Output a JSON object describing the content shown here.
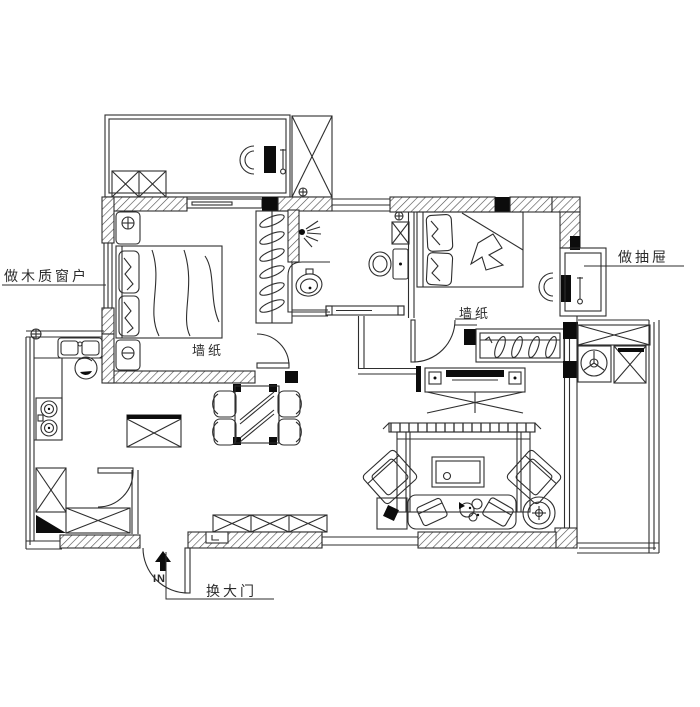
{
  "colors": {
    "background": "#ffffff",
    "ink": "#2e2e2e",
    "solid_wall_fill": "#0c0c0c"
  },
  "labels": {
    "wooden_window": "做木质窗户",
    "drawer": "做抽屉",
    "wallpaper_master": "墙纸",
    "wallpaper_second": "墙纸",
    "entry_door": "换大门",
    "in_marker": "IN"
  }
}
